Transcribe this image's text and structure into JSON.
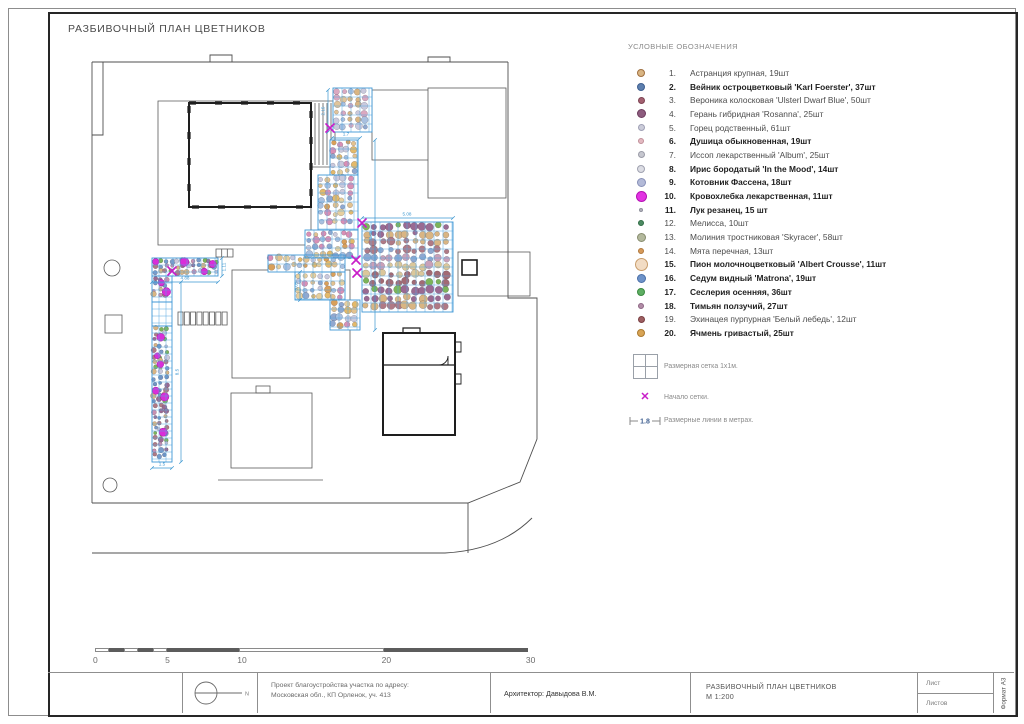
{
  "page": {
    "title": "РАЗБИВОЧНЫЙ ПЛАН ЦВЕТНИКОВ"
  },
  "legend": {
    "header": "УСЛОВНЫЕ ОБОЗНАЧЕНИЯ",
    "items": [
      {
        "num": "1.",
        "label": "Астранция крупная, 19шт",
        "color": "#d9b583",
        "ring": "#a07040",
        "size": 8,
        "bold": false
      },
      {
        "num": "2.",
        "label": "Вейник остроцветковый 'Karl Foerster', 37шт",
        "color": "#5d7fae",
        "ring": "#3f5f90",
        "size": 8,
        "bold": true
      },
      {
        "num": "3.",
        "label": "Вероника колосковая 'Ulsterl Dwarf Blue', 50шт",
        "color": "#a36171",
        "ring": "#7e4353",
        "size": 7,
        "bold": false
      },
      {
        "num": "4.",
        "label": "Герань гибридная 'Rosanna', 25шт",
        "color": "#8d5c7e",
        "ring": "#6d3c5e",
        "size": 9,
        "bold": false
      },
      {
        "num": "5.",
        "label": "Горец родственный, 61шт",
        "color": "#cbccd9",
        "ring": "#9fa0b5",
        "size": 7,
        "bold": false
      },
      {
        "num": "6.",
        "label": "Душица обыкновенная, 19шт",
        "color": "#e3b9c1",
        "ring": "#c08f99",
        "size": 6,
        "bold": true
      },
      {
        "num": "7.",
        "label": "Иссоп лекарственный 'Album', 25шт",
        "color": "#c6c7cf",
        "ring": "#9b9ca8",
        "size": 7,
        "bold": false
      },
      {
        "num": "8.",
        "label": "Ирис бородатый 'In the Mood', 14шт",
        "color": "#dcdde4",
        "ring": "#a0a2b0",
        "size": 8,
        "bold": true
      },
      {
        "num": "9.",
        "label": "Котовник Фассена, 18шт",
        "color": "#b3bad8",
        "ring": "#8890b8",
        "size": 9,
        "bold": true
      },
      {
        "num": "10.",
        "label": "Кровохлебка лекарственная, 11шт",
        "color": "#e233e2",
        "ring": "#b511b5",
        "size": 11,
        "bold": true
      },
      {
        "num": "11.",
        "label": "Лук резанец, 15 шт",
        "color": "#b5b6c0",
        "ring": "#8f909c",
        "size": 4,
        "bold": true
      },
      {
        "num": "12.",
        "label": "Мелисса, 10шт",
        "color": "#4d8a62",
        "ring": "#2f6c44",
        "size": 6,
        "bold": false
      },
      {
        "num": "13.",
        "label": "Молиния тростниковая 'Skyracer', 58шт",
        "color": "#b3b89c",
        "ring": "#878c6e",
        "size": 9,
        "bold": false
      },
      {
        "num": "14.",
        "label": "Мята перечная, 13шт",
        "color": "#d69a5a",
        "ring": "#b0783c",
        "size": 6,
        "bold": false
      },
      {
        "num": "15.",
        "label": "Пион молочноцветковый 'Albert Crousse', 11шт",
        "color": "#f2dcc4",
        "ring": "#c89c6a",
        "size": 13,
        "bold": true
      },
      {
        "num": "16.",
        "label": "Седум видный 'Matrona', 19шт",
        "color": "#6e93c9",
        "ring": "#4a6fa8",
        "size": 9,
        "bold": true
      },
      {
        "num": "17.",
        "label": "Сеслерия осенняя, 36шт",
        "color": "#5eae63",
        "ring": "#3b8a41",
        "size": 8,
        "bold": true
      },
      {
        "num": "18.",
        "label": "Тимьян ползучий, 27шт",
        "color": "#b18ca6",
        "ring": "#8d6684",
        "size": 6,
        "bold": true
      },
      {
        "num": "19.",
        "label": "Эхинацея пурпурная 'Белый лебедь', 12шт",
        "color": "#9d5f62",
        "ring": "#7a3f42",
        "size": 7,
        "bold": false
      },
      {
        "num": "20.",
        "label": "Ячмень гривастый, 25шт",
        "color": "#d8a455",
        "ring": "#ab7a30",
        "size": 8,
        "bold": true
      }
    ],
    "symbols": [
      {
        "label": "Размерная сетка 1х1м."
      },
      {
        "label": "Начало сетки."
      },
      {
        "label": "Размерные линии в метрах.",
        "value": "1.8"
      }
    ]
  },
  "scalebar": {
    "labels": [
      "0",
      "5",
      "10",
      "20",
      "30"
    ]
  },
  "titleblock": {
    "project_line1": "Проект благоустройства участка по адресу:",
    "project_line2": "Московская обл., КП Орленок, уч. 413",
    "architect": "Архитектор: Давыдова В.М.",
    "drawing_title": "РАЗБИВОЧНЫЙ ПЛАН ЦВЕТНИКОВ",
    "scale": "М 1:200",
    "sheet_label": "Лист",
    "sheets_label": "Листов",
    "format_label": "Формат А3",
    "north_label": "N"
  },
  "plan": {
    "colors": {
      "grid": "#58a8e0",
      "bed_outline": "#3f97d6",
      "dim": "#3a96d0",
      "mark": "#c81ec8",
      "accent": "#d92ed9"
    },
    "palettes": {
      "mixA": [
        "#d9b583",
        "#8fa8d0",
        "#c9c9dd",
        "#dba8c0",
        "#e0c49a",
        "#a8c0e0"
      ],
      "warm": [
        "#e3b96a",
        "#d9a05a",
        "#8fa8d0",
        "#c9c9dd",
        "#e3c28f",
        "#d98fb5",
        "#a8c0e0",
        "#e6cf9e"
      ],
      "mixC": [
        "#7cb45a",
        "#9a6a92",
        "#d9b583",
        "#b07a85",
        "#8fa8d0",
        "#c9a0b8",
        "#dbc79a",
        "#a26a74"
      ],
      "mixD": [
        "#7a9ac8",
        "#c98fb0",
        "#b07a85",
        "#7cb45a",
        "#c9c9dd",
        "#9a6a92",
        "#d9b583",
        "#6f93c4"
      ]
    },
    "beds": [
      {
        "name": "bed-top",
        "rects": [
          [
            273,
            40,
            39,
            44
          ]
        ],
        "palette": "mixA",
        "cell": 9,
        "step": 7,
        "seed": 11,
        "accents": 0,
        "mode": "random"
      },
      {
        "name": "bed-center",
        "rects": [
          [
            270,
            92,
            28,
            35
          ],
          [
            258,
            127,
            40,
            55
          ],
          [
            245,
            182,
            53,
            28
          ],
          [
            208,
            207,
            77,
            17
          ],
          [
            235,
            224,
            50,
            28
          ],
          [
            270,
            252,
            30,
            30
          ]
        ],
        "palette": "warm",
        "cell": 9,
        "step": 7,
        "seed": 22,
        "accents": 0,
        "mode": "random"
      },
      {
        "name": "bed-right",
        "rects": [
          [
            302,
            174,
            91,
            90
          ]
        ],
        "palette": "mixC",
        "cell": 9,
        "step": 8,
        "seed": 33,
        "accents": 0,
        "mode": "rows"
      },
      {
        "name": "bed-left",
        "rects": [
          [
            92,
            210,
            66,
            18
          ],
          [
            92,
            228,
            20,
            26
          ],
          [
            92,
            278,
            20,
            136
          ]
        ],
        "palette": "mixD",
        "cell": 7,
        "step": 5.5,
        "seed": 44,
        "accents": 12,
        "mode": "random",
        "gridExtra": [
          [
            92,
            254,
            20,
            24
          ]
        ]
      }
    ],
    "dims": [
      {
        "x1": 268,
        "y1": 42,
        "x2": 268,
        "y2": 84,
        "label": "2.15",
        "lx": 264.5,
        "ly": 63,
        "rot": -90
      },
      {
        "x1": 272,
        "y1": 90,
        "x2": 300,
        "y2": 90,
        "label": "1.7",
        "lx": 286,
        "ly": 87.5,
        "rot": 0
      },
      {
        "x1": 315,
        "y1": 92,
        "x2": 315,
        "y2": 282,
        "label": "8.06",
        "lx": 312,
        "ly": 187,
        "rot": -90
      },
      {
        "x1": 302,
        "y1": 170,
        "x2": 393,
        "y2": 170,
        "label": "5.08",
        "lx": 347,
        "ly": 167.5,
        "rot": 0
      },
      {
        "x1": 92,
        "y1": 234,
        "x2": 158,
        "y2": 234,
        "label": "4.88",
        "lx": 125,
        "ly": 231.5,
        "rot": 0
      },
      {
        "x1": 162,
        "y1": 210,
        "x2": 162,
        "y2": 228,
        "label": "1.11",
        "lx": 165.5,
        "ly": 219,
        "rot": -90
      },
      {
        "x1": 121,
        "y1": 234,
        "x2": 121,
        "y2": 414,
        "label": "8.5",
        "lx": 118.5,
        "ly": 324,
        "rot": -90
      },
      {
        "x1": 92,
        "y1": 420,
        "x2": 112,
        "y2": 420,
        "label": "1.5",
        "lx": 102,
        "ly": 417.5,
        "rot": 0
      },
      {
        "x1": 240,
        "y1": 224,
        "x2": 240,
        "y2": 252,
        "label": "3.05",
        "lx": 237.5,
        "ly": 238,
        "rot": -90
      }
    ],
    "x_marks": [
      [
        270,
        80
      ],
      [
        302,
        175
      ],
      [
        296,
        212
      ],
      [
        297,
        225
      ],
      [
        112,
        223
      ]
    ]
  }
}
